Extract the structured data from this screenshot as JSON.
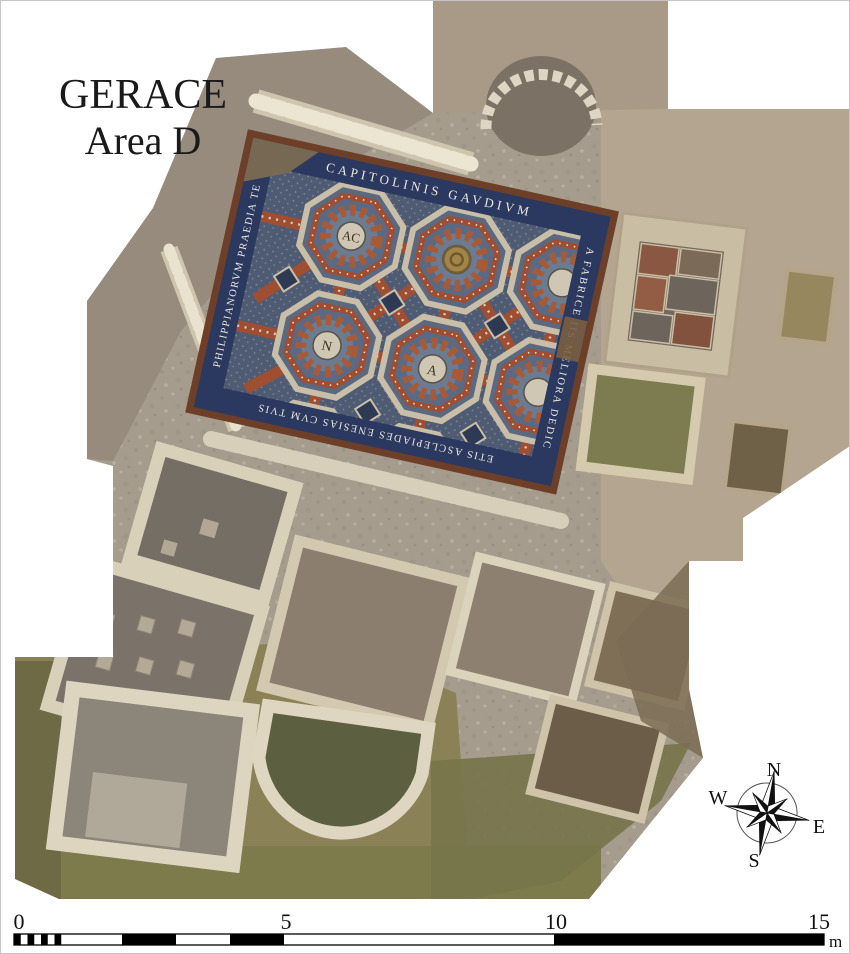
{
  "figure": {
    "title_line1": "GERACE",
    "title_line2": "Area D"
  },
  "compass": {
    "north": "N",
    "east": "E",
    "south": "S",
    "west": "W"
  },
  "scale_bar": {
    "tick_labels": [
      "0",
      "5",
      "10",
      "15"
    ],
    "unit": "m"
  },
  "mosaic": {
    "inscription_top": "CAPITOLINIS GAVDIVM",
    "inscription_right": "A FABRICE IIS MELIORA DEDIC",
    "inscription_bottom": "ETIS ASCLEPIADES ENESIAS CVM TVIS",
    "inscription_left": "PHILIPPIANORVM PRAEDIA TE",
    "monogram_1": "AC",
    "monogram_2": "N",
    "monogram_3": "A"
  },
  "colors": {
    "mosaic_band_blue": "#2b3860",
    "mosaic_lattice_red": "#9f4e31",
    "ground_grey": "#a69c8e",
    "olive_soil": "#8a8156"
  }
}
